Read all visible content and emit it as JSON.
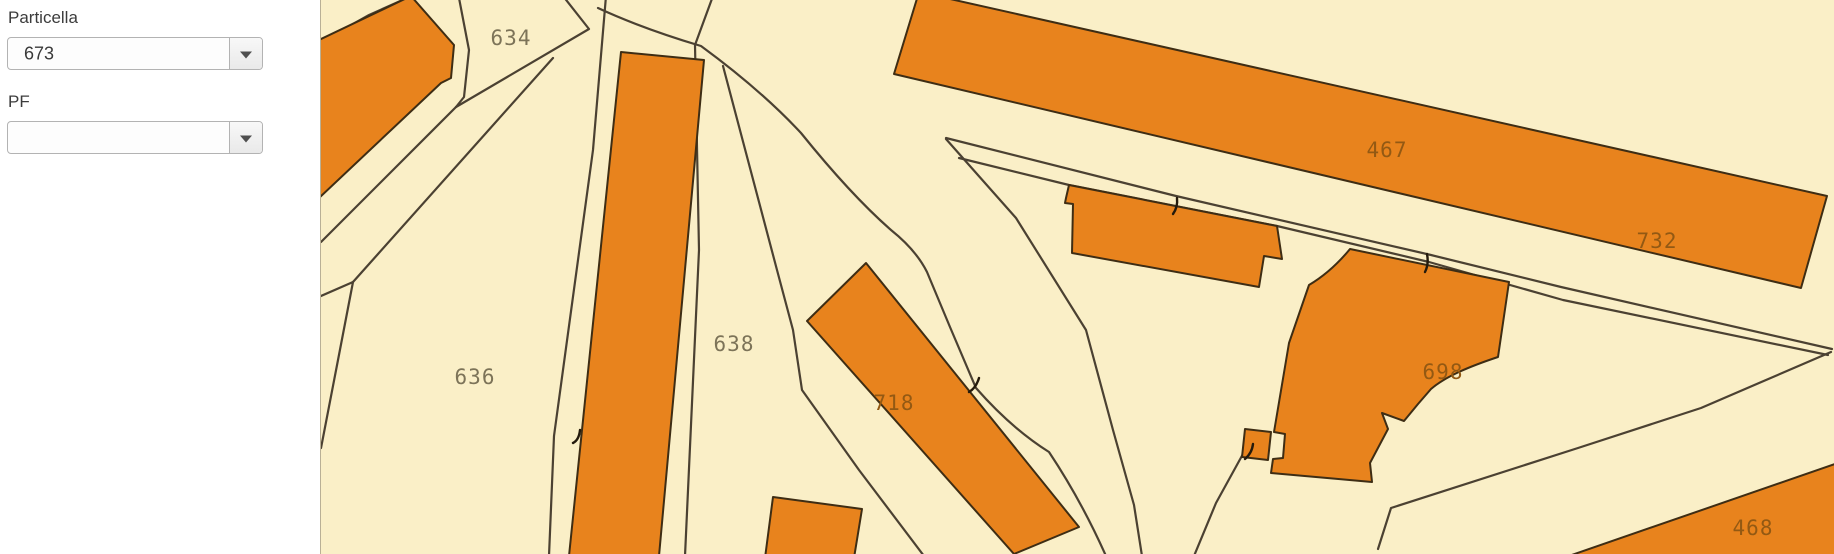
{
  "app": {
    "type": "cadastral-map-viewer"
  },
  "sidebar": {
    "fields": [
      {
        "label": "Particella",
        "value": "673"
      },
      {
        "label": "PF",
        "value": ""
      }
    ]
  },
  "map": {
    "parcel_labels": [
      {
        "text": "634",
        "on": "cream",
        "x": 510,
        "y": 45
      },
      {
        "text": "636",
        "on": "cream",
        "x": 474,
        "y": 384
      },
      {
        "text": "638",
        "on": "cream",
        "x": 733,
        "y": 351
      },
      {
        "text": "718",
        "on": "building",
        "x": 893,
        "y": 410
      },
      {
        "text": "467",
        "on": "building",
        "x": 1386,
        "y": 157
      },
      {
        "text": "732",
        "on": "building",
        "x": 1656,
        "y": 248
      },
      {
        "text": "698",
        "on": "building",
        "x": 1442,
        "y": 379
      },
      {
        "text": "468",
        "on": "building",
        "x": 1752,
        "y": 535
      }
    ],
    "colors": {
      "background": "#faefc7",
      "building_fill": "#e8831d",
      "building_outline": "#3e2d14",
      "parcel_line": "#4b4132",
      "label_on_cream": "#7c7358",
      "label_on_building": "#935913"
    }
  }
}
